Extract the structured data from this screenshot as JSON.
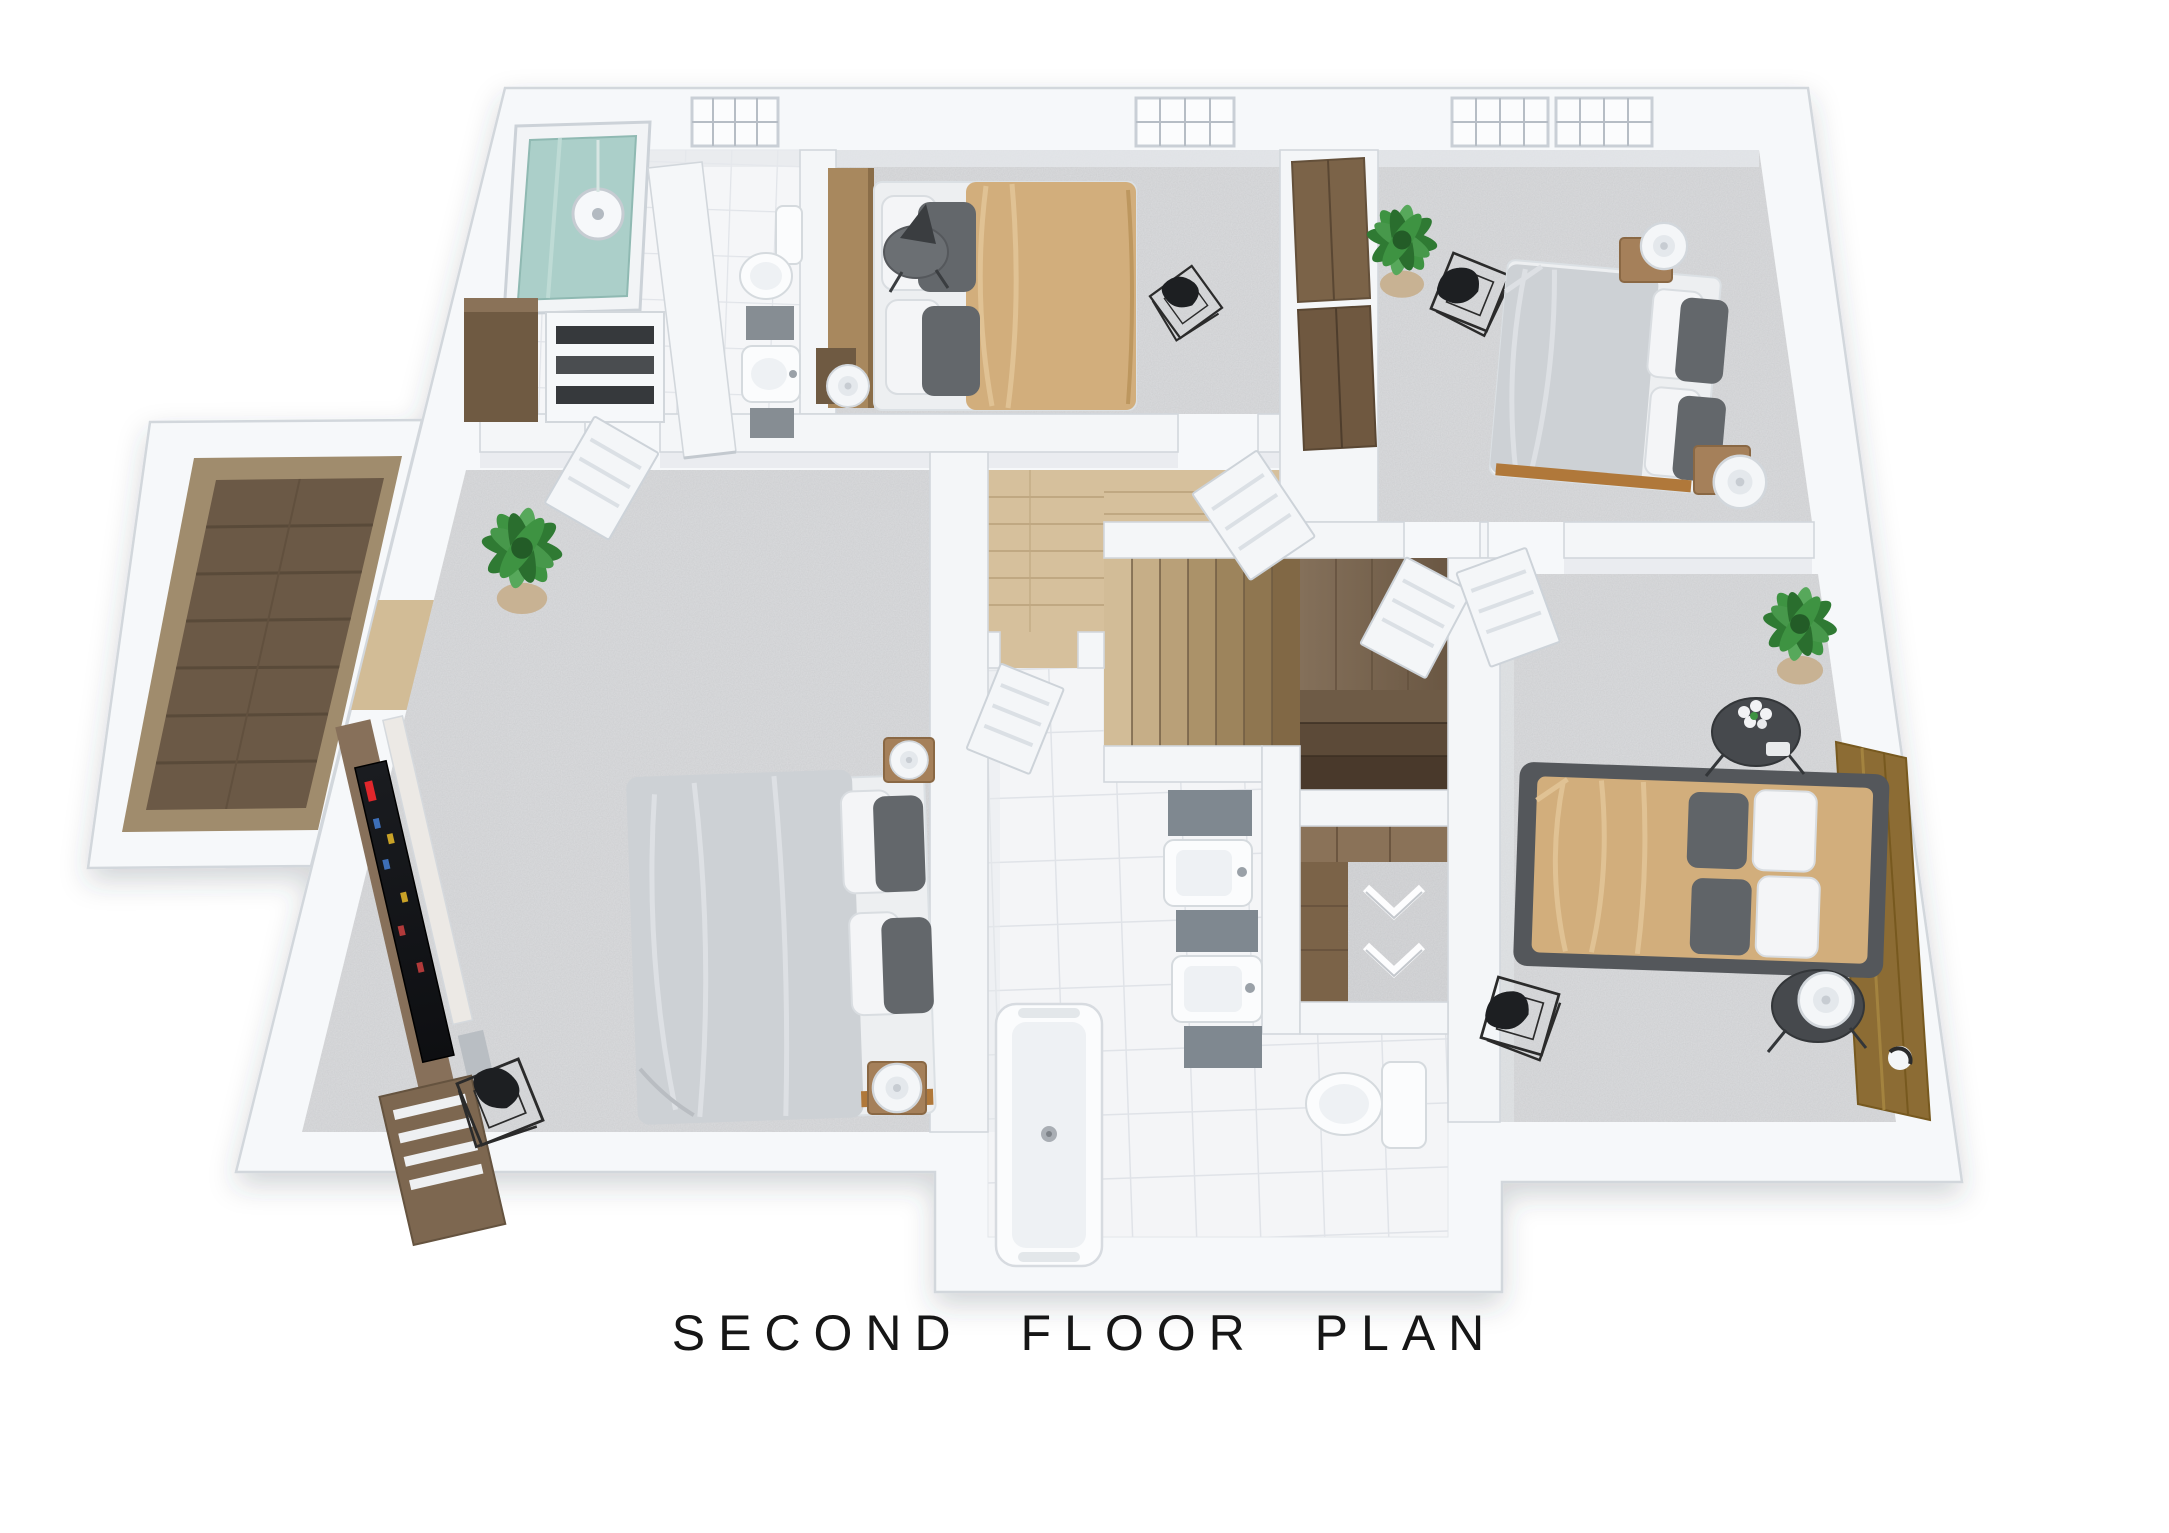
{
  "title": {
    "text": "SECOND FLOOR PLAN"
  },
  "palette": {
    "background": "#ffffff",
    "wall_fill": "#f4f6f8",
    "wall_edge": "#d2d7dc",
    "wall_face": "#e6e9ed",
    "carpet": "#dbdcde",
    "tile": "#f4f5f7",
    "tile_line": "#e0e3e8",
    "wood_hall": "#d6c09c",
    "wood_stair_light": "#d2bc97",
    "wood_stair_dark": "#49392b",
    "wood_balcony": "#6b5946",
    "wood_furniture": "#9a7850",
    "bed_tan": "#d2ae7c",
    "bed_gray": "#cdd1d5",
    "pillow_white": "#f4f5f7",
    "pillow_gray": "#63676b",
    "headboard_leather": "#8c6c34",
    "shower_glass": "#a7ccc6",
    "plant_green": "#3e9342",
    "tv_screen": "#141518",
    "tv_accent": "#e0272c",
    "wire_chair": "#2b2b2b",
    "title_color": "#161616"
  },
  "plan": {
    "label": "SECOND FLOOR PLAN",
    "view": "3d-top-down-render",
    "rooms": [
      {
        "id": "ensuite-bathroom",
        "floor": "white-tile",
        "features": [
          "glass-shower",
          "toilet",
          "sink-vanity",
          "storage-shelves",
          "window"
        ]
      },
      {
        "id": "bedroom-top-middle",
        "floor": "carpet",
        "features": [
          "double-bed",
          "wood-headboard",
          "round-side-table",
          "cone-lamp",
          "cylinder-lamp",
          "wire-chair",
          "wardrobe-closet",
          "window"
        ]
      },
      {
        "id": "bedroom-top-right",
        "floor": "carpet",
        "features": [
          "double-bed",
          "two-nightstands",
          "cylinder-lamps",
          "wire-chair",
          "potted-plant",
          "two-windows"
        ]
      },
      {
        "id": "master-bedroom",
        "floor": "carpet",
        "features": [
          "double-bed",
          "two-nightstands",
          "tv-media-wall",
          "wire-chair",
          "potted-plant",
          "balcony-access"
        ]
      },
      {
        "id": "balcony-deck",
        "floor": "wood-plank",
        "features": [
          "parapet-walls"
        ]
      },
      {
        "id": "hallway-stairs",
        "floor": "light-wood",
        "features": [
          "staircase",
          "wood-landing",
          "lower-flight"
        ]
      },
      {
        "id": "family-bathroom",
        "floor": "white-tile",
        "features": [
          "bathtub",
          "double-sink-vanity",
          "toilet",
          "walk-in-closet"
        ]
      },
      {
        "id": "bedroom-right",
        "floor": "carpet",
        "features": [
          "double-bed",
          "leather-headboard-panel",
          "wall-sconces",
          "round-side-tables",
          "flower-vase",
          "potted-plant",
          "wire-chair"
        ]
      }
    ]
  }
}
